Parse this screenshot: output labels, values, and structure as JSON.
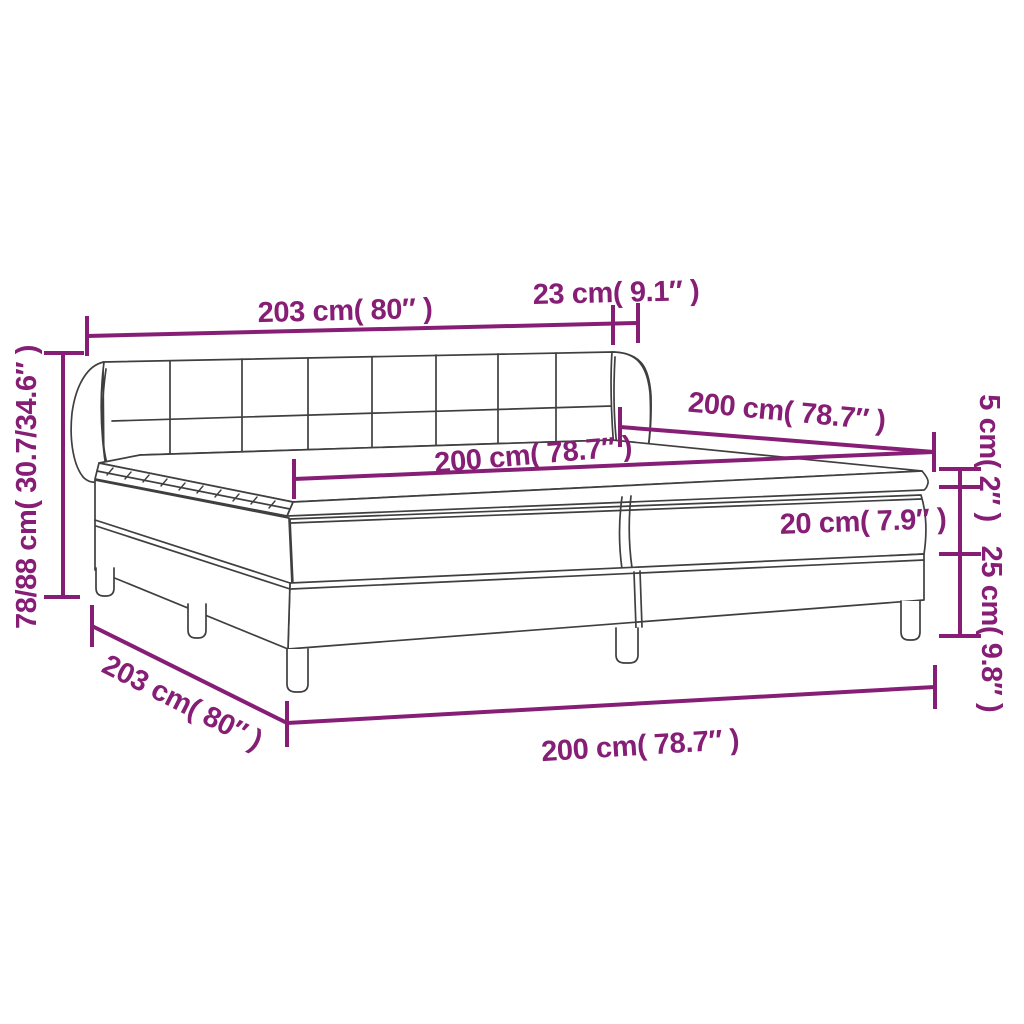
{
  "diagram": {
    "title": "box-spring-bed-dimension-diagram",
    "colors": {
      "dimension_accent": "#861e76",
      "line_art": "#3f3f3f",
      "background": "#ffffff"
    },
    "dimensions": {
      "headboard_width_top": {
        "label": "203 cm( 80″ )"
      },
      "headboard_depth": {
        "label": "23 cm( 9.1″ )"
      },
      "bed_length_right": {
        "label": "200 cm( 78.7″ )"
      },
      "mattress_width": {
        "label": "200 cm( 78.7″ )"
      },
      "topper_height": {
        "label": "5 cm( 2″ )"
      },
      "mattress_height": {
        "label": "20 cm( 7.9″ )"
      },
      "base_height": {
        "label": "25 cm( 9.8″ )"
      },
      "total_height_left": {
        "label": "78/88 cm( 30.7/34.6″ )"
      },
      "frame_width_diagonal": {
        "label": "203 cm( 80″ )"
      },
      "frame_length_bottom": {
        "label": "200 cm( 78.7″ )"
      }
    }
  }
}
